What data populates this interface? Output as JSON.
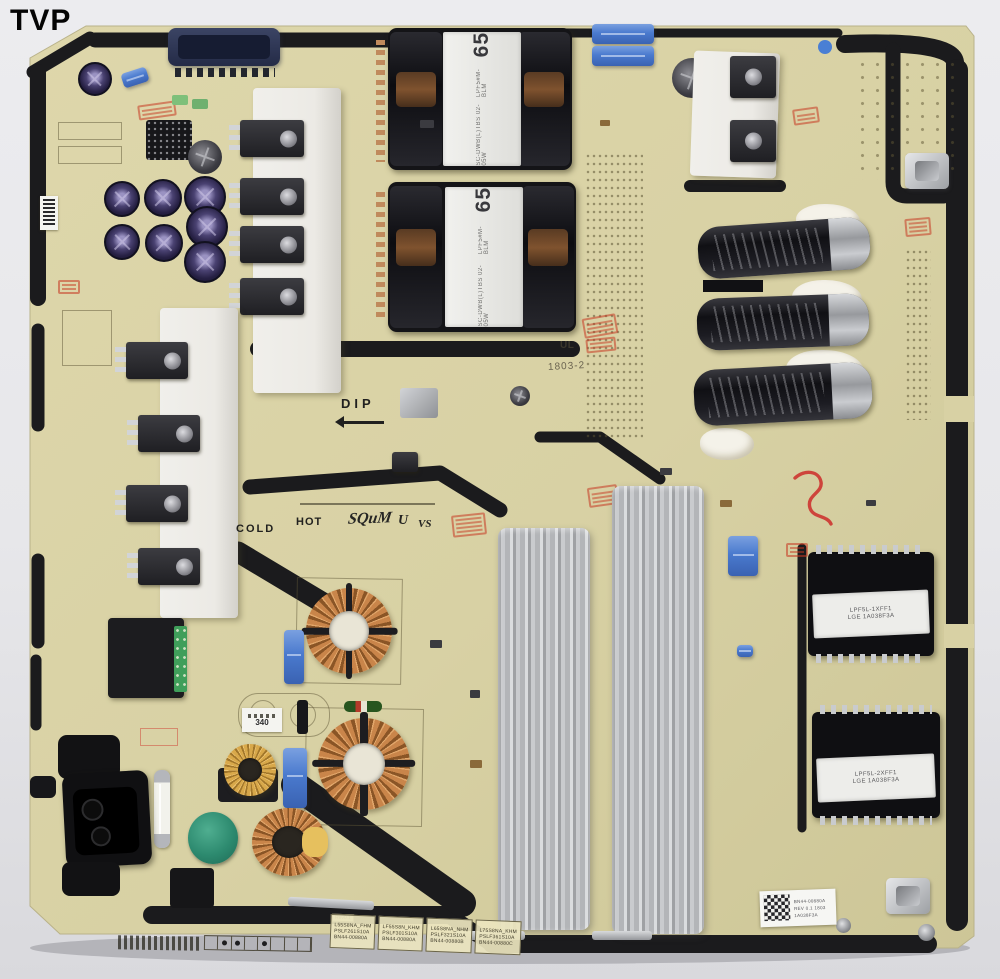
{
  "watermark": "TVP",
  "silkscreen": {
    "dip": "DIP",
    "hot": "HOT",
    "cold": "COLD",
    "brand": "SQuM",
    "cert1": "U",
    "cert2": "VS",
    "ul_mark": "UL",
    "date_code": "1803-2"
  },
  "transformers": {
    "t1": {
      "size": "65",
      "part": "LPF5#M-BLM",
      "spec": "SC-DWB(L)TBS 02-05W"
    },
    "t2": {
      "size": "65",
      "part": "LPF5#M-BLM",
      "spec": "SC-DWB(L)TBS 02-05W"
    },
    "t3": {
      "part": "LPF5L-1XFF1",
      "lot": "LGE 1A038F3A"
    },
    "t4": {
      "part": "LPF5L-2XFF1",
      "lot": "LGE 1A038F3A"
    }
  },
  "labels": {
    "mini": "340",
    "qr_line1": "BN44-00880A",
    "qr_line2": "REV 0.1 1803",
    "qr_line3": "1A038F3A"
  },
  "part_table": {
    "rev_tab": "Rev0.1",
    "cells": [
      {
        "line1": "L55S8NA_FHM",
        "line2": "PSLF261S10A",
        "line3": "BN44-00880A"
      },
      {
        "line1": "LF55S8N_KHM",
        "line2": "PSLF301S10A",
        "line3": "BN44-00880A"
      },
      {
        "line1": "L65S8NA_NHM",
        "line2": "PSLF321S10A",
        "line3": "BN44-00880B"
      },
      {
        "line1": "L75S8NA_KHM",
        "line2": "PSLF361S10A",
        "line3": "BN44-00880C"
      }
    ]
  },
  "colors": {
    "board": "#d8d1a4",
    "trace": "#1b1b1d",
    "accent_blue": "#4a7fd4",
    "copper": "#c08040",
    "stamp_red": "#c3432f"
  }
}
